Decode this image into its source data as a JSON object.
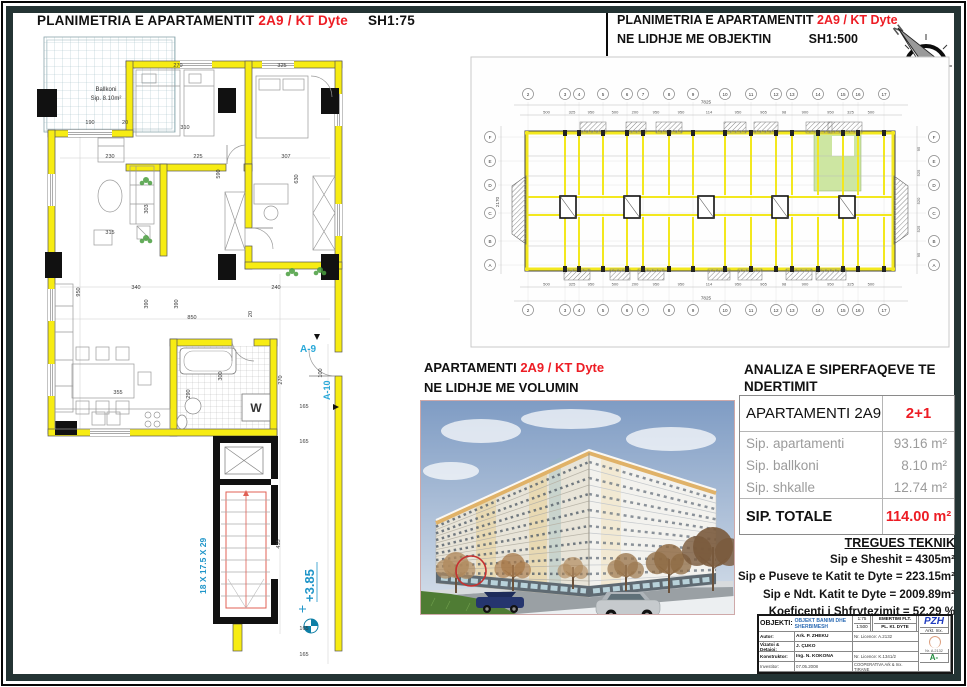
{
  "colors": {
    "accent_red": "#ed1c24",
    "wall_yellow": "#f7ec13",
    "highlight_green": "#cde6a2",
    "annotation_cyan": "#2196c9",
    "frame_dark": "#243434",
    "pzh_blue": "#1f3bbf",
    "objekti_blue": "#2f6db5",
    "mark_green": "#1f8a3c"
  },
  "plan75": {
    "title": "PLANIMETRIA E APARTAMENTIT",
    "title_unit": "2A9 / KT Dyte",
    "title_scale": "SH1:75",
    "balcony_line1": "Ballkoni",
    "balcony_line2": "Sip. 8.10m²",
    "w_label": "W",
    "stair_note": "18 X 17.5 X 29",
    "level": "+3.85",
    "marker_a9": "A-9",
    "marker_a10": "A-10",
    "dims": [
      "270",
      "325",
      "190",
      "20",
      "310",
      "230",
      "225",
      "307",
      "590",
      "630",
      "303",
      "315",
      "950",
      "340",
      "390",
      "390",
      "850",
      "240",
      "20",
      "355",
      "300",
      "290",
      "270",
      "100",
      "165",
      "165",
      "435",
      "165",
      "165"
    ]
  },
  "plan500": {
    "title": "PLANIMETRIA E APARTAMENTIT",
    "title_unit": "2A9 / KT Dyte",
    "subtitle": "NE LIDHJE ME OBJEKTIN",
    "subtitle_scale": "SH1:500",
    "compass": "N",
    "grid_numbers": [
      "2",
      "3",
      "4",
      "5",
      "6",
      "7",
      "8",
      "9",
      "10",
      "11",
      "12",
      "13",
      "14",
      "15",
      "16",
      "17"
    ],
    "grid_letters": [
      "F",
      "E",
      "D",
      "C",
      "B",
      "A"
    ],
    "top_segments": [
      "500",
      "325",
      "950",
      "500",
      "200",
      "950",
      "950",
      "114",
      "950",
      "965",
      "98",
      "900",
      "950",
      "325",
      "500"
    ],
    "side_segments": [
      "95",
      "525",
      "520",
      "525",
      "95"
    ],
    "total_width": "7825",
    "total_height": "2170"
  },
  "volume": {
    "title": "APARTAMENTI",
    "title_unit": "2A9 / KT Dyte",
    "subtitle": "NE LIDHJE ME VOLUMIN"
  },
  "analysis": {
    "heading_line1": "ANALIZA E SIPERFAQEVE TE",
    "heading_line2": "NDERTIMIT",
    "apartment_label": "APARTAMENTI 2A9",
    "apartment_type": "2+1",
    "rows": [
      {
        "label": "Sip. apartamenti",
        "value": "93.16 m²"
      },
      {
        "label": "Sip. ballkoni",
        "value": "8.10 m²"
      },
      {
        "label": "Sip. shkalle",
        "value": "12.74 m²"
      }
    ],
    "total_label": "SIP. TOTALE",
    "total_value": "114.00 m²"
  },
  "tregues": {
    "heading": "TREGUES TEKNIK",
    "lines": [
      "Sip e Sheshit = 4305m²",
      "Sip e Puseve te Katit te Dyte = 223.15m²",
      "Sip e Ndt. Katit te Dyte = 2009.89m²",
      "Koeficenti i Shfrytezimit = 52.29 %"
    ]
  },
  "titleblock": {
    "objekti_label": "OBJEKTI:",
    "objekti_value": "OBJEKT BANIMI DHE SHERBIMESH",
    "scale_line1": "1:75",
    "scale_line2": "1:500",
    "emertimi_line1": "EMERTIMI FLT.",
    "emertimi_line2": "PL. Kt. DYTE",
    "logo": "PZH",
    "logo_sub": "Arkt. Inx.",
    "logo_nr": "Nr. A.2132",
    "mark": "A-",
    "rows": [
      {
        "label": "Autor:",
        "value": "Ark. P. ZHEKU",
        "extra": "Nr. Licence: A.2132"
      },
      {
        "label": "Vizatoi & Detajoi:",
        "value": "J. ÇUKO",
        "extra": ""
      },
      {
        "label": "Konstruktor:",
        "value": "Ing. N. KOKONA",
        "extra": "Nr. Licence: K.1341/2"
      }
    ],
    "footer_label": "Investitor:",
    "footer_date": "07.05.2008",
    "footer_note": "COOPERATIVA Ark & Inx. TIRANE"
  }
}
